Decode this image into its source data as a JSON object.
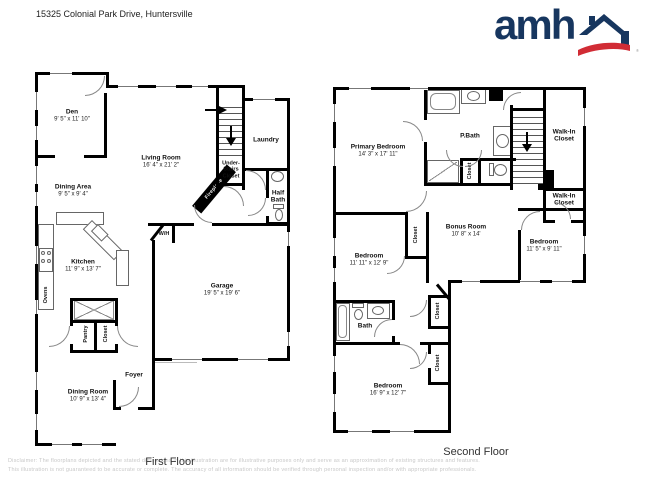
{
  "header": {
    "address": "15325 Colonial Park Drive, Huntersville",
    "logo": {
      "text": "amh",
      "registered": "®"
    }
  },
  "colors": {
    "logo_blue": "#17365f",
    "logo_red": "#d12c35",
    "wall": "#000000"
  },
  "first_floor": {
    "title": "First Floor",
    "rooms": {
      "den": {
        "name": "Den",
        "dims": "9' 5\" x 11' 10\""
      },
      "dining_area": {
        "name": "Dining Area",
        "dims": "9' 5\" x 9' 4\""
      },
      "living_room": {
        "name": "Living Room",
        "dims": "16' 4\" x 21' 2\""
      },
      "kitchen": {
        "name": "Kitchen",
        "dims": "11' 9\" x 13' 7\""
      },
      "dining_room": {
        "name": "Dining Room",
        "dims": "10' 9\" x 13' 4\""
      },
      "garage": {
        "name": "Garage",
        "dims": "19' 5\" x 19' 6\""
      },
      "laundry": {
        "name": "Laundry"
      },
      "half_bath": {
        "name": "Half Bath"
      },
      "foyer": {
        "name": "Foyer"
      },
      "pantry": {
        "name": "Pantry"
      },
      "closet": {
        "name": "Closet"
      },
      "under_stairs_closet": {
        "name": "Under-Stairs Closet"
      },
      "fireplace": {
        "name": "Fireplace"
      },
      "wh": {
        "name": "W/H"
      },
      "ovens": {
        "name": "Ovens"
      }
    }
  },
  "second_floor": {
    "title": "Second Floor",
    "rooms": {
      "primary_bedroom": {
        "name": "Primary Bedroom",
        "dims": "14' 3\" x 17' 11\""
      },
      "p_bath": {
        "name": "P.Bath"
      },
      "walk_in_closet_1": {
        "name": "Walk-In Closet"
      },
      "walk_in_closet_2": {
        "name": "Walk-In Closet"
      },
      "bonus_room": {
        "name": "Bonus Room",
        "dims": "10' 8\" x 14'"
      },
      "bedroom_left": {
        "name": "Bedroom",
        "dims": "11' 11\" x 12' 9\""
      },
      "bedroom_right": {
        "name": "Bedroom",
        "dims": "11' 5\" x 9' 11\""
      },
      "bedroom_bottom": {
        "name": "Bedroom",
        "dims": "16' 9\" x 12' 7\""
      },
      "bath": {
        "name": "Bath"
      },
      "closet_pbath": {
        "name": "Closet"
      },
      "closet_hall": {
        "name": "Closet"
      },
      "closet_upper": {
        "name": "Closet"
      },
      "closet_lower": {
        "name": "Closet"
      }
    }
  },
  "footer": {
    "disclaimer_line1": "Disclaimer: The floorplans depicted and the stated dimensions in this illustration are for illustrative purposes only and serve as an approximation of existing structures and features.",
    "disclaimer_line2": "This illustration is not guaranteed to be accurate or complete. The accuracy of all information should be verified through personal inspection and/or with appropriate professionals."
  }
}
